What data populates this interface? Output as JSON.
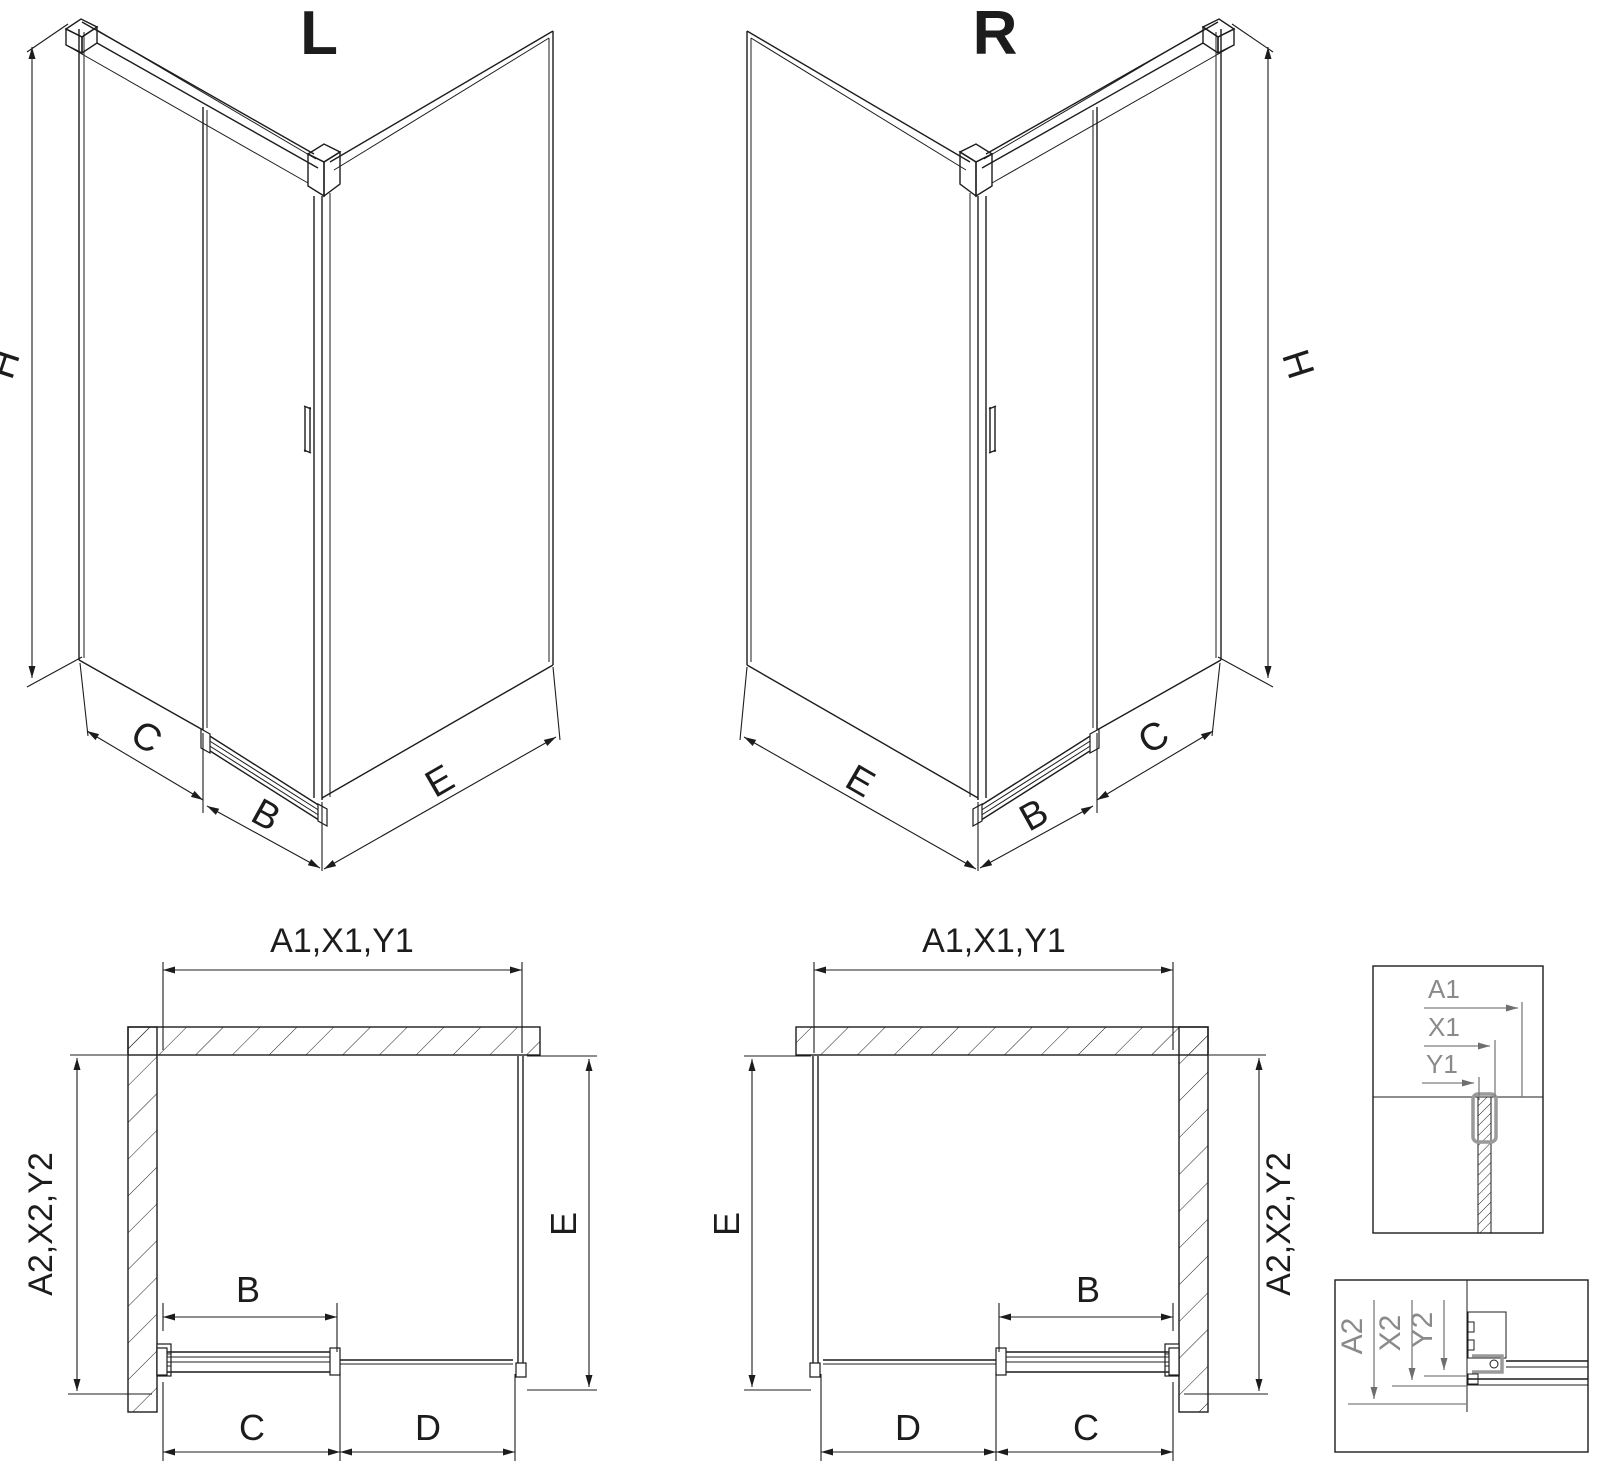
{
  "iso_left": {
    "variant": "L",
    "h": "H",
    "c": "C",
    "b": "B",
    "e": "E"
  },
  "iso_right": {
    "variant": "R",
    "h": "H",
    "c": "C",
    "b": "B",
    "e": "E"
  },
  "plan_left": {
    "width": "A1,X1,Y1",
    "depth": "A2,X2,Y2",
    "side": "E",
    "door": "B",
    "seg1": "C",
    "seg2": "D"
  },
  "plan_right": {
    "width": "A1,X1,Y1",
    "depth": "A2,X2,Y2",
    "side": "E",
    "door": "B",
    "seg1": "D",
    "seg2": "C"
  },
  "detail_width": {
    "a1": "A1",
    "x1": "X1",
    "y1": "Y1"
  },
  "detail_depth": {
    "a2": "A2",
    "x2": "X2",
    "y2": "Y2"
  },
  "colors": {
    "line": "#1c1c1c",
    "detail_label": "#8a8a8a",
    "clamp_highlight": "#9a9a9a",
    "background": "#ffffff"
  }
}
